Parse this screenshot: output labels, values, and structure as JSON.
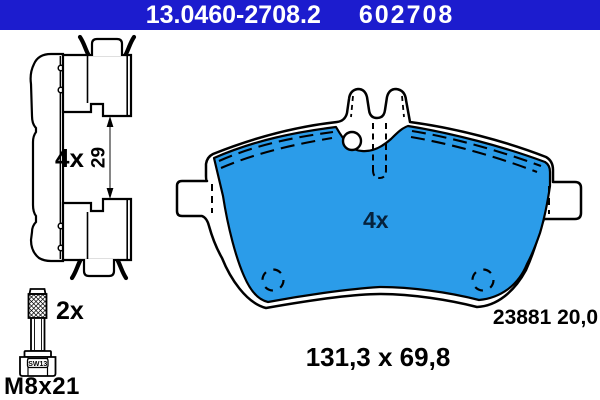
{
  "header": {
    "part_number": "13.0460-2708.2",
    "catalog_number": "602708",
    "bg_color": "#1c1cce",
    "text_color": "#ffffff"
  },
  "side_view": {
    "quantity_label": "4x",
    "height_dimension": "29"
  },
  "bolt": {
    "quantity_label": "2x",
    "thread_size_label": "M8x21",
    "wrench_size_label": "SW13"
  },
  "pad_front": {
    "quantity_label": "4x",
    "wva_thickness_label": "23881 20,0",
    "dimensions_label": "131,3 x 69,8",
    "friction_color": "#2b9ce9"
  }
}
